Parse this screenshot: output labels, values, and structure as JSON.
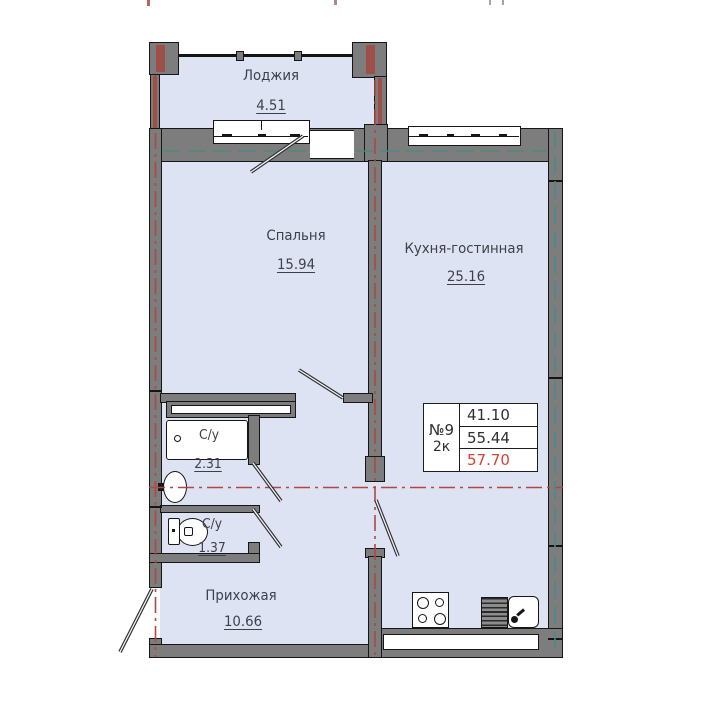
{
  "rooms": {
    "loggia": {
      "name": "Лоджия",
      "area": "4.51"
    },
    "bedroom": {
      "name": "Спальня",
      "area": "15.94"
    },
    "kitchen": {
      "name": "Кухня-гостинная",
      "area": "25.16"
    },
    "bath1": {
      "name": "С/у",
      "area": "2.31"
    },
    "bath2": {
      "name": "С/у",
      "area": "1.37"
    },
    "hallway": {
      "name": "Прихожая",
      "area": "10.66"
    }
  },
  "info_box": {
    "number": "№9",
    "type": "2к",
    "value1": "41.10",
    "value2": "55.44",
    "value3": "57.70"
  },
  "colors": {
    "floor": "#dee3f3",
    "wall": "#7d7d7d",
    "axis_red": "#b04840",
    "axis_teal": "#4d8a82",
    "total_highlight": "#d84038"
  }
}
